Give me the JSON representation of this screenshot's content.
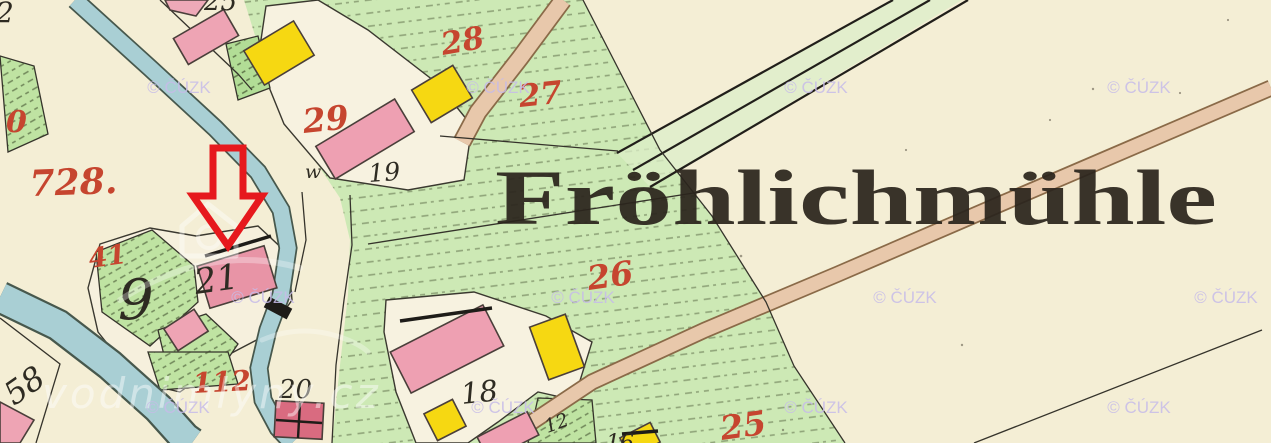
{
  "map": {
    "place_label": "Fröhlichmühle",
    "red_parcel_numbers": {
      "p728": "728.",
      "p0_partial": "0",
      "p41": "41",
      "p112": "112",
      "p29": "29",
      "p28": "28",
      "p27": "27",
      "p26": "26",
      "p25": "25"
    },
    "black_numbers": {
      "n2_partial": "2",
      "n25_partial": "25",
      "n9": "9",
      "n21": "21",
      "nw": "w",
      "n19": "19",
      "n18": "18",
      "n20": "20",
      "n58": "58",
      "n12": "12",
      "n16": "16"
    },
    "watermarks": {
      "cuzk": "© ČÚZK",
      "site": "vodnimlyny.cz"
    },
    "annotation_arrow": {
      "color": "#e6191d",
      "direction": "down"
    },
    "legend_colors": {
      "paper": "#f4eed5",
      "meadow_green": "#cde9b5",
      "garden_green": "#bfe3a2",
      "masonry_building_pink": "#eea4b4",
      "wooden_building_yellow": "#f6d812",
      "water_blue": "#a9cfd4",
      "road_tan": "#e8c8ab",
      "parcel_number_red": "#c6452f"
    }
  }
}
